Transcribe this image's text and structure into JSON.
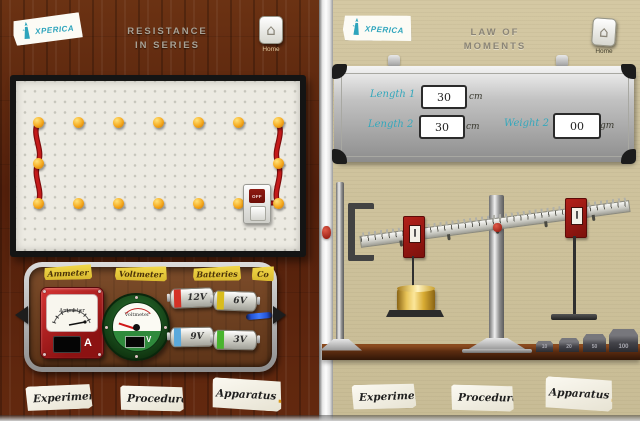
{
  "shared": {
    "logo_text": "xperica",
    "home_label": "Home"
  },
  "left_panel": {
    "title_line1": "RESISTANCE",
    "title_line2": "IN SERIES",
    "tray_section_labels": [
      "Ammeter",
      "Voltmeter",
      "Batteries",
      "Co"
    ],
    "ammeter": {
      "dial_label": "Ammeter",
      "unit": "A"
    },
    "voltmeter": {
      "dial_label": "Voltmeter",
      "unit": "V"
    },
    "batteries": [
      {
        "label": "12V",
        "stripe_color": "#d43226"
      },
      {
        "label": "6V",
        "stripe_color": "#d9bc1c"
      },
      {
        "label": "9V",
        "stripe_color": "#5aa9dc"
      },
      {
        "label": "3V",
        "stripe_color": "#49b42e"
      }
    ],
    "switch_label": "OFF",
    "footer_labels": [
      "Experiment",
      "Procedure",
      "Apparatus"
    ]
  },
  "right_panel": {
    "title_line1": "LAW OF",
    "title_line2": "MOMENTS",
    "whiteboard_fields": [
      {
        "label": "Length 1",
        "value": "30",
        "unit": "cm"
      },
      {
        "label": "Length 2",
        "value": "30",
        "unit": "cm"
      },
      {
        "label": "Weight 2",
        "value": "00",
        "unit": "gm"
      }
    ],
    "table_weights": [
      "10",
      "20",
      "50",
      "100"
    ],
    "footer_labels": [
      "Experiment",
      "Procedure",
      "Apparatus"
    ]
  },
  "colors": {
    "accent_teal": "#2da4bc",
    "wood_brown": "#5e2a10",
    "paper_beige": "#cfc49e",
    "meter_red": "#a81b12",
    "meter_green": "#1d4f23",
    "peg_yellow": "#f5a81c",
    "wire_red": "#b01010"
  }
}
